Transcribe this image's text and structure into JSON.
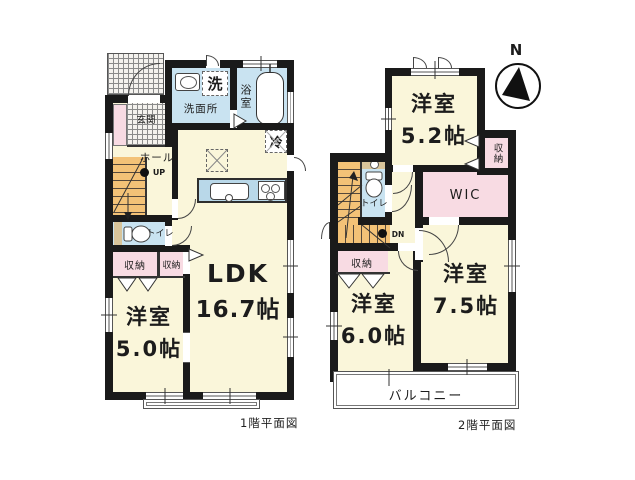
{
  "compass": "N",
  "colors": {
    "wall": "#1a1a1a",
    "room_cream": "#faf6da",
    "wet_area_blue": "#c9e3f1",
    "closet_pink": "#f8dbe3",
    "stairs_orange": "#f3c277",
    "counter_tan": "#d8c49a"
  },
  "floor1": {
    "caption": "1階平面図",
    "ldk": {
      "name": "LDK",
      "size": "16.7帖"
    },
    "bedroom": {
      "name": "洋室",
      "size": "5.0帖"
    },
    "washroom": "洗面所",
    "laundry": "洗",
    "bath": "浴室",
    "fridge": "冷",
    "entrance": "玄関",
    "hall": "ホール",
    "stairs": "UP",
    "toilet": "トイレ",
    "closet_a": "収納",
    "closet_b": "収納"
  },
  "floor2": {
    "caption": "2階平面図",
    "bedroom_52": {
      "name": "洋室",
      "size": "5.2帖"
    },
    "bedroom_60": {
      "name": "洋室",
      "size": "6.0帖"
    },
    "bedroom_75": {
      "name": "洋室",
      "size": "7.5帖"
    },
    "closet_52": "収納",
    "wic": "WIC",
    "toilet": "トイレ",
    "stairs": "DN",
    "closet_60": "収納",
    "balcony": "バルコニー"
  }
}
